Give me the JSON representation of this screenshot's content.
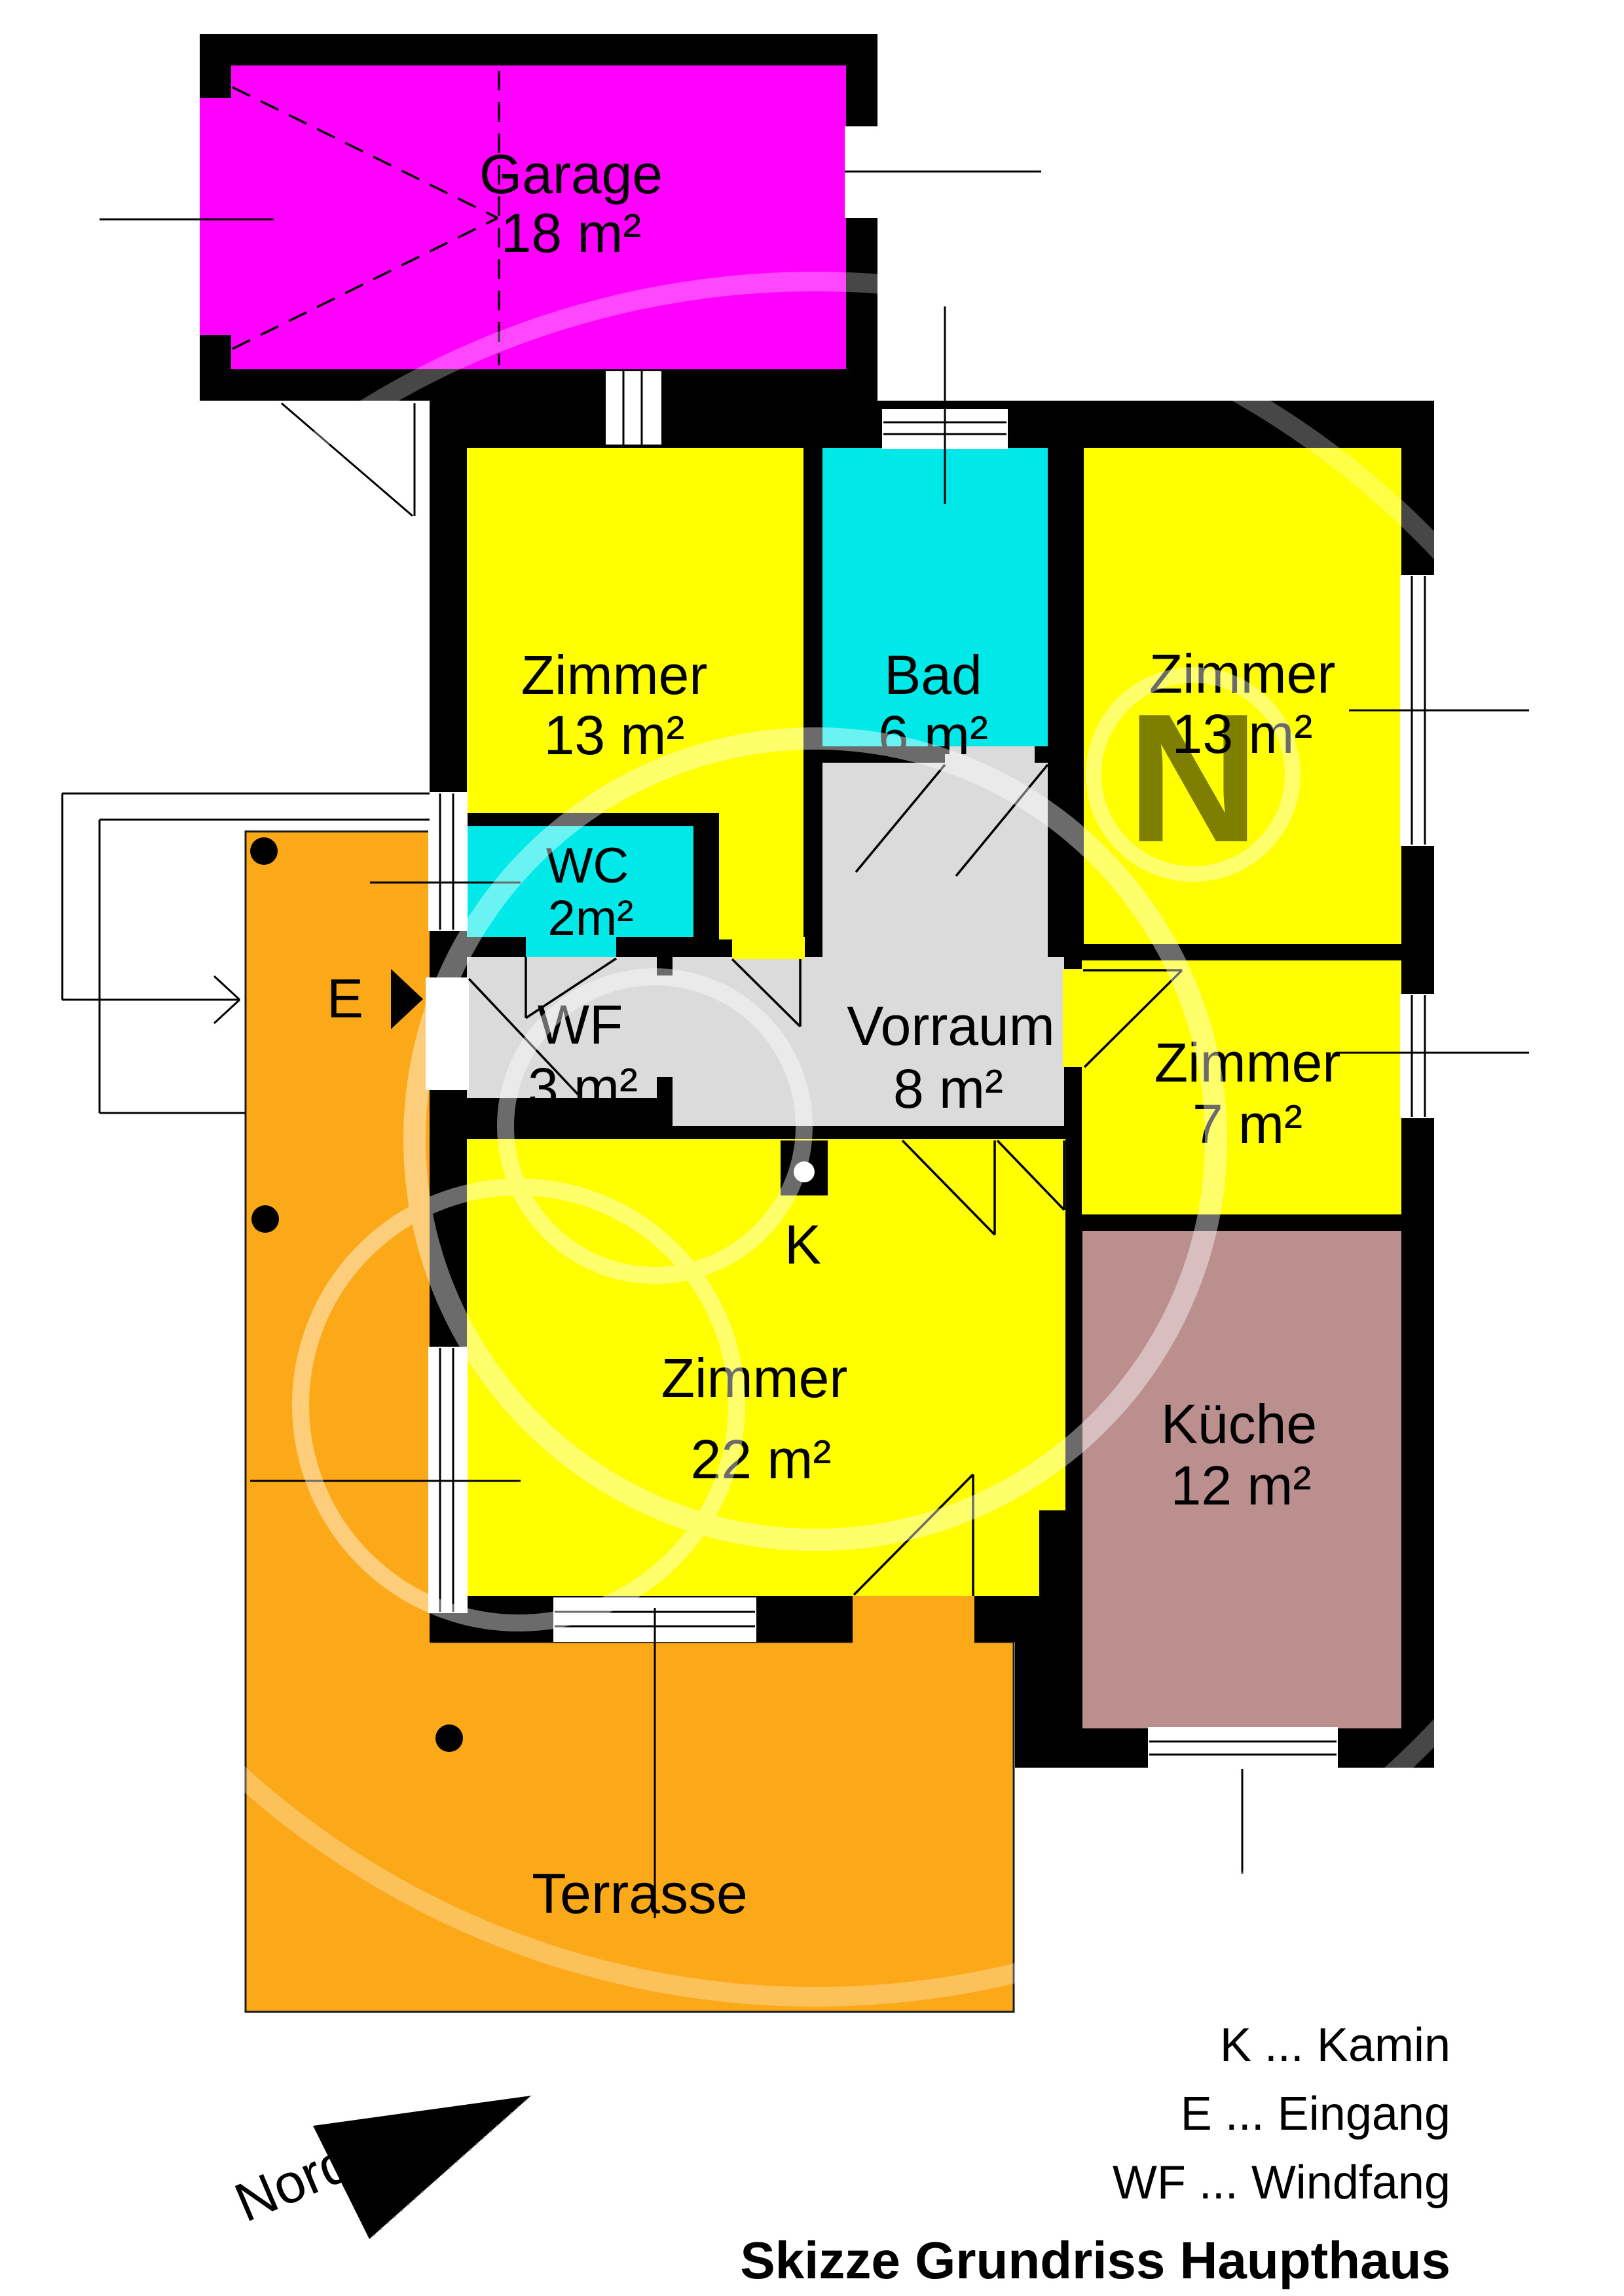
{
  "title": "Skizze Grundriss Haupthaus",
  "north": {
    "label": "Norden"
  },
  "legend": {
    "items": [
      {
        "abbr": "K",
        "meaning": "Kamin",
        "text": "K ... Kamin"
      },
      {
        "abbr": "E",
        "meaning": "Eingang",
        "text": "E ... Eingang"
      },
      {
        "abbr": "WF",
        "meaning": "Windfang",
        "text": "WF ... Windfang"
      }
    ]
  },
  "markers": {
    "kamin": "K",
    "eingang": "E"
  },
  "watermark": {
    "letter": "N"
  },
  "rooms": {
    "garage": {
      "name": "Garage",
      "area": "18 m²",
      "color": "#FF00FF"
    },
    "zimmer_nw": {
      "name": "Zimmer",
      "area": "13 m²",
      "color": "#FFFF00"
    },
    "bad": {
      "name": "Bad",
      "area": "6 m²",
      "color": "#00E9E9"
    },
    "zimmer_ne": {
      "name": "Zimmer",
      "area": "13 m²",
      "color": "#FFFF00"
    },
    "wc": {
      "name": "WC",
      "area": "2m²",
      "color": "#00E9E9"
    },
    "wf": {
      "name": "WF",
      "area": "3 m²",
      "color": "#DBDBDB"
    },
    "vorraum": {
      "name": "Vorraum",
      "area": "8 m²",
      "color": "#DBDBDB"
    },
    "zimmer_e": {
      "name": "Zimmer",
      "area": "7 m²",
      "color": "#FFFF00"
    },
    "zimmer_sw": {
      "name": "Zimmer",
      "area": "22 m²",
      "color": "#FFFF00"
    },
    "kueche": {
      "name": "Küche",
      "area": "12 m²",
      "color": "#BC8F8F"
    },
    "terrasse": {
      "name": "Terrasse",
      "color": "#FBA919"
    }
  },
  "colors": {
    "wall": "#000000",
    "background": "#FFFFFF",
    "watermark": "#FFFFFF"
  }
}
